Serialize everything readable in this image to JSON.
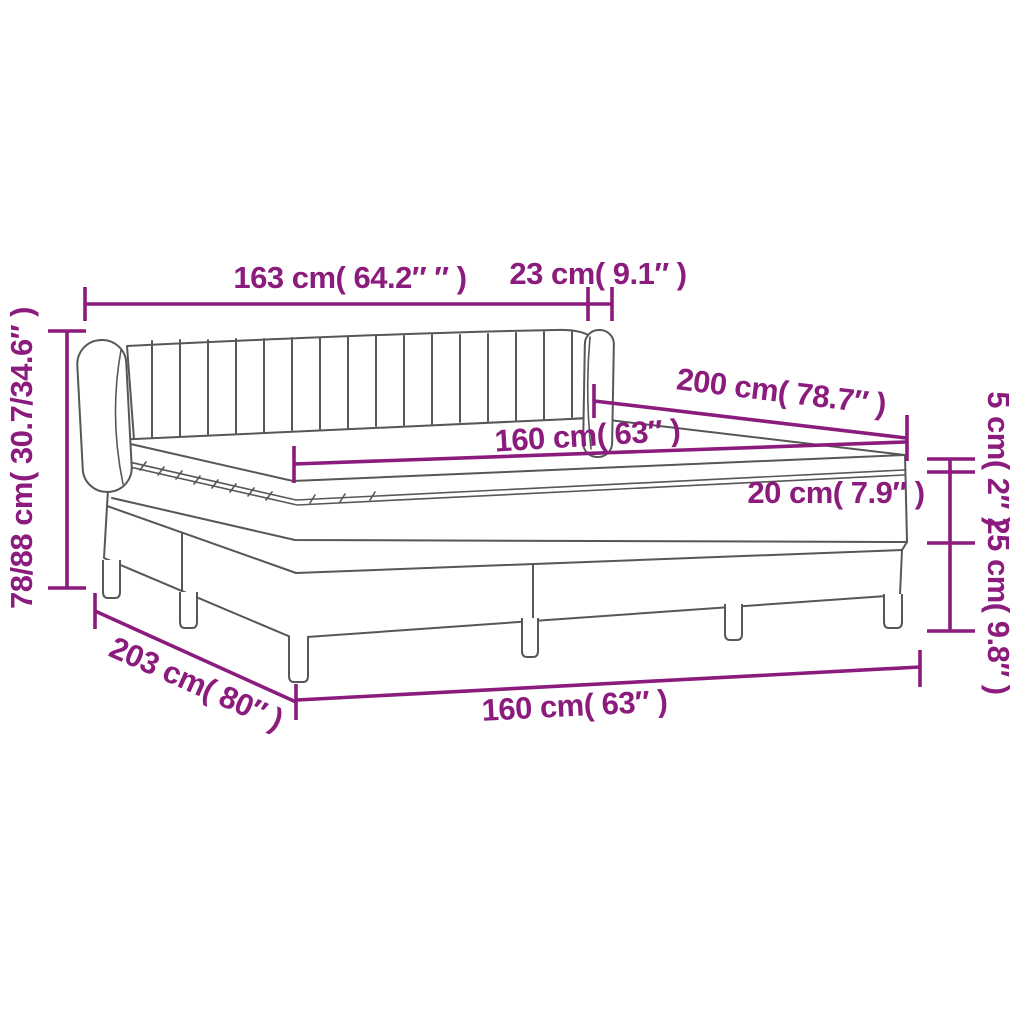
{
  "figure": {
    "type": "product-dimension-diagram",
    "subject": "box spring bed with channel-tufted headboard, mattress and topper"
  },
  "colors": {
    "accent": "#8b1c7d",
    "line": "#575757",
    "background": "#ffffff"
  },
  "labels": {
    "overall_width_top": "163 cm( 64.2″ ″ )",
    "headboard_depth": "23 cm( 9.1″ )",
    "overall_height": "78/88 cm( 30.7/34.6″ )",
    "mattress_length": "200 cm( 78.7″ )",
    "mattress_width": "160 cm( 63″ )",
    "topper_height": "5 cm( 2″ )",
    "mattress_height": "20 cm( 7.9″ )",
    "base_height": "25 cm( 9.8″ )",
    "overall_length": "203 cm( 80″ )",
    "base_width": "160 cm( 63″ )"
  }
}
